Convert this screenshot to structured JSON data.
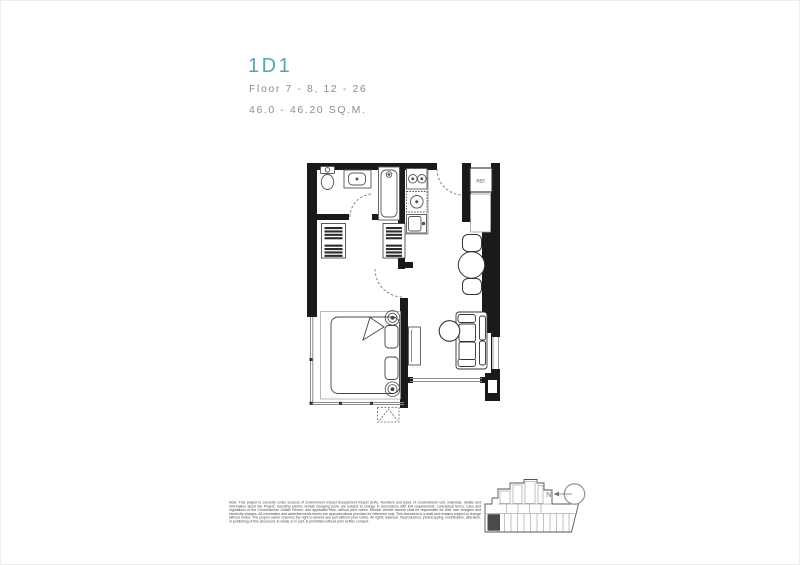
{
  "header": {
    "unit_code": "1D1",
    "floor_range": "Floor 7 - 8, 12 - 26",
    "area_range": "46.0 - 46.20 SQ.M."
  },
  "floorplan": {
    "ref_label": "REF."
  },
  "keyplan": {
    "north_label": "N"
  },
  "disclaimer": "Note: This project is currently under process of Environment Impact Assessment Report (EIA). Numbers and types of condominium unit, materials, details and information about the Project, including electric vehicle charging point, are subject to change in accordance with EIA requirements, contractual terms, rules and regulations of the Condominium Juristic Person, and applicable fees, without prior notice. Electric vehicle owners shall be responsible for their own chargers and electricity charges. All information and advertisements herein are approximations provided for reference only. This document is a draft and remains subject to change without notice. The project owner reserves the right to amend any part without prior notice. All rights reserved. Reproduction, photocopying, modification, alteration, or publishing of this document, in whole or in part, is prohibited without prior written consent.",
  "colors": {
    "accent": "#52A7B1",
    "muted_text": "#8D8D8D",
    "wall": "#1A1A1A",
    "fixture_line": "#555555",
    "disclaimer_text": "#474747",
    "keyplan_highlight": "#4A4A4A"
  }
}
